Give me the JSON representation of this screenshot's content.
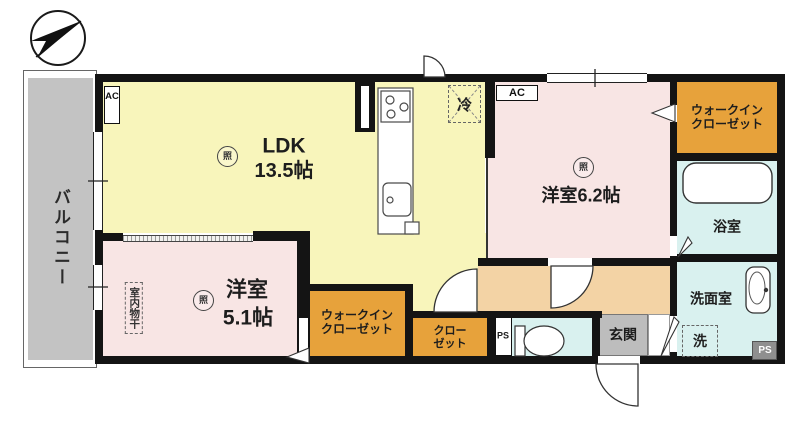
{
  "plan_title": "apartment-floorplan",
  "balcony": {
    "label": "バルコニー"
  },
  "ldk": {
    "name": "LDK",
    "size": "13.5帖",
    "light_mark": "照",
    "ac_label": "AC",
    "fridge_label": "冷"
  },
  "bedroom_62": {
    "label": "洋室6.2帖",
    "light_mark": "照",
    "ac_label": "AC"
  },
  "bedroom_51": {
    "name": "洋室",
    "size": "5.1帖",
    "light_mark": "照",
    "indoor_drying": "室内物干"
  },
  "walk_in_closet": {
    "line1": "ウォークイン",
    "line2": "クローゼット"
  },
  "closet": {
    "line1": "クロー",
    "line2": "ゼット"
  },
  "bathroom": {
    "label": "浴室"
  },
  "washroom": {
    "label": "洗面室",
    "washer_label": "洗"
  },
  "entrance": {
    "label": "玄関"
  },
  "pipe_space": {
    "label": "PS"
  },
  "colors": {
    "wall": "#141414",
    "ldk_fill": "#f8f5bb",
    "bedroom_fill": "#f8e5e4",
    "hallway_fill": "#f3d3a5",
    "closet_fill": "#e7a23b",
    "wet_area_fill": "#d9f1ef",
    "balcony_fill": "#c3c3c3",
    "entrance_fill": "#bdbdbd",
    "pipe_space_fill": "#8f8f8f"
  }
}
